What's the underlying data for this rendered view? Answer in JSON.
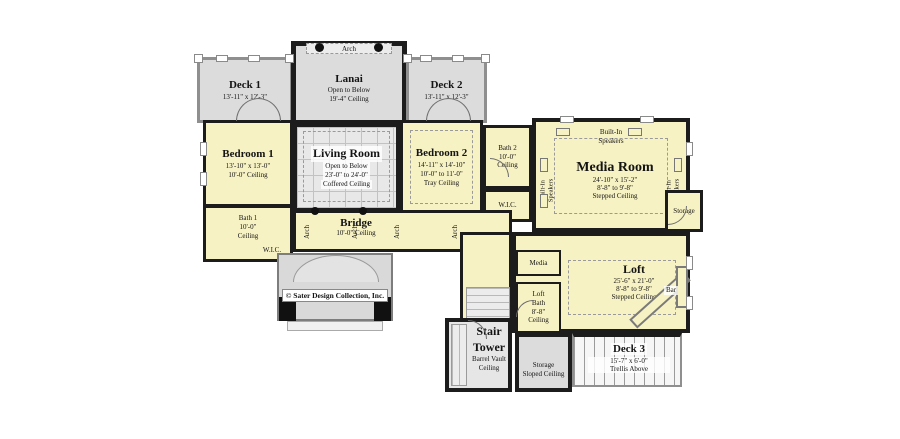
{
  "copyright": "© Sater Design Collection, Inc.",
  "labels": {
    "arch": "Arch",
    "built_in": "Built-In",
    "speakers": "Speakers"
  },
  "colors": {
    "room_fill": "#f7f2c3",
    "deck_fill": "#dcdcdc",
    "open_fill": "#e8e8e8",
    "wall": "#1c1c1c"
  },
  "rooms": {
    "deck1": {
      "name": "Deck 1",
      "dim": "13'-11\" x 12'-3\""
    },
    "lanai": {
      "name": "Lanai",
      "sub1": "Open to Below",
      "sub2": "19'-4\" Ceiling"
    },
    "deck2": {
      "name": "Deck 2",
      "dim": "13'-11\" x 12'-3\""
    },
    "bedroom1": {
      "name": "Bedroom 1",
      "dim": "13'-10\" x 13'-0\"",
      "sub": "10'-0\" Ceiling"
    },
    "living": {
      "name": "Living Room",
      "sub1": "Open to Below",
      "sub2": "23'-0\" to 24'-0\"",
      "sub3": "Coffered Ceiling"
    },
    "bedroom2": {
      "name": "Bedroom 2",
      "dim": "14'-11\" x 14'-10\"",
      "sub2": "10'-0\" to 11'-0\"",
      "sub3": "Tray Ceiling"
    },
    "bath1": {
      "name": "Bath 1",
      "sub1": "10'-0\"",
      "sub2": "Ceiling"
    },
    "bath2": {
      "name": "Bath 2",
      "sub1": "10'-0\"",
      "sub2": "Ceiling"
    },
    "wic": {
      "name": "W.I.C."
    },
    "bridge": {
      "name": "Bridge",
      "sub": "10'-0\" Ceiling"
    },
    "media_room": {
      "name": "Media Room",
      "dim": "24'-10\" x 15'-2\"",
      "sub2": "8'-8\" to 9'-8\"",
      "sub3": "Stepped Ceiling"
    },
    "storage": {
      "name": "Storage"
    },
    "media_closet": {
      "name": "Media"
    },
    "loft": {
      "name": "Loft",
      "dim": "25'-6\" x 21'-0\"",
      "sub2": "8'-8\" to 9'-8\"",
      "sub3": "Stepped Ceiling"
    },
    "loft_bath": {
      "l1": "Loft",
      "l2": "Bath",
      "l3": "8'-8\"",
      "l4": "Ceiling"
    },
    "bar": {
      "name": "Bar"
    },
    "stair_tower": {
      "name": "Stair Tower",
      "sub1": "Barrel Vault",
      "sub2": "Ceiling"
    },
    "storage_sloped": {
      "l1": "Storage",
      "l2": "Sloped Ceiling"
    },
    "deck3": {
      "name": "Deck 3",
      "dim": "15'-7\" x 6'-0\"",
      "sub": "Trellis Above"
    }
  }
}
